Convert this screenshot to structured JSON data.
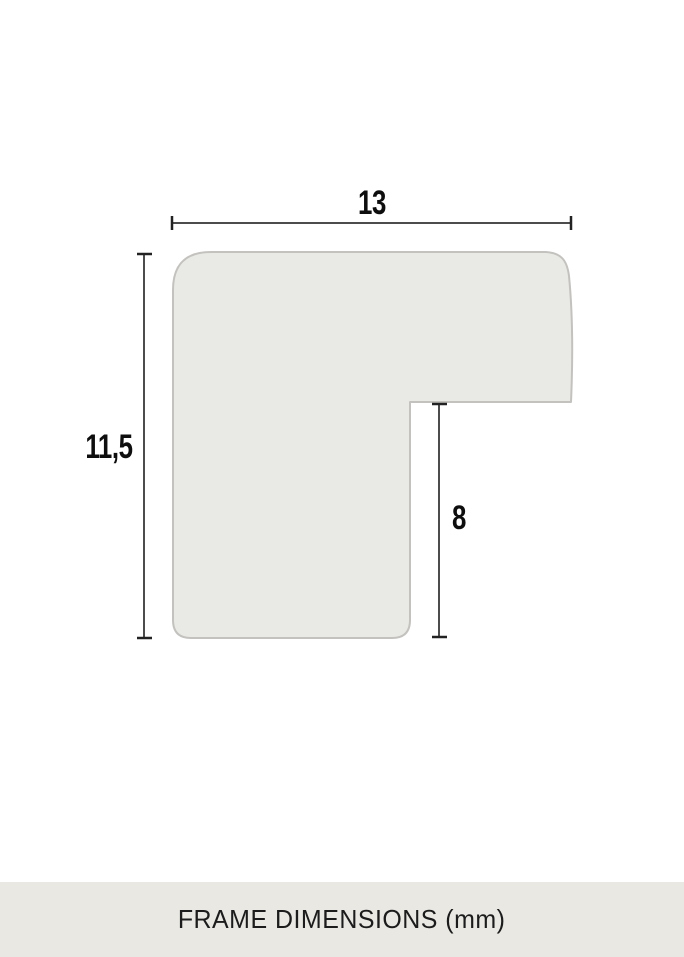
{
  "diagram": {
    "title": "frame moulding profile cross-section",
    "width_label": "13",
    "height_label": "11,5",
    "rebate_label": "8",
    "units": "mm"
  },
  "footer": {
    "caption": "FRAME DIMENSIONS (mm)"
  },
  "colors": {
    "background": "#ffffff",
    "profile_fill": "#e9e9e5",
    "profile_stroke": "#c3c2be",
    "dimension_line": "#4c4c4c",
    "dimension_tick": "#222222",
    "label_text": "#0e0e0e",
    "footer_background": "#e9e8e3",
    "footer_text": "#1c1c1c"
  }
}
